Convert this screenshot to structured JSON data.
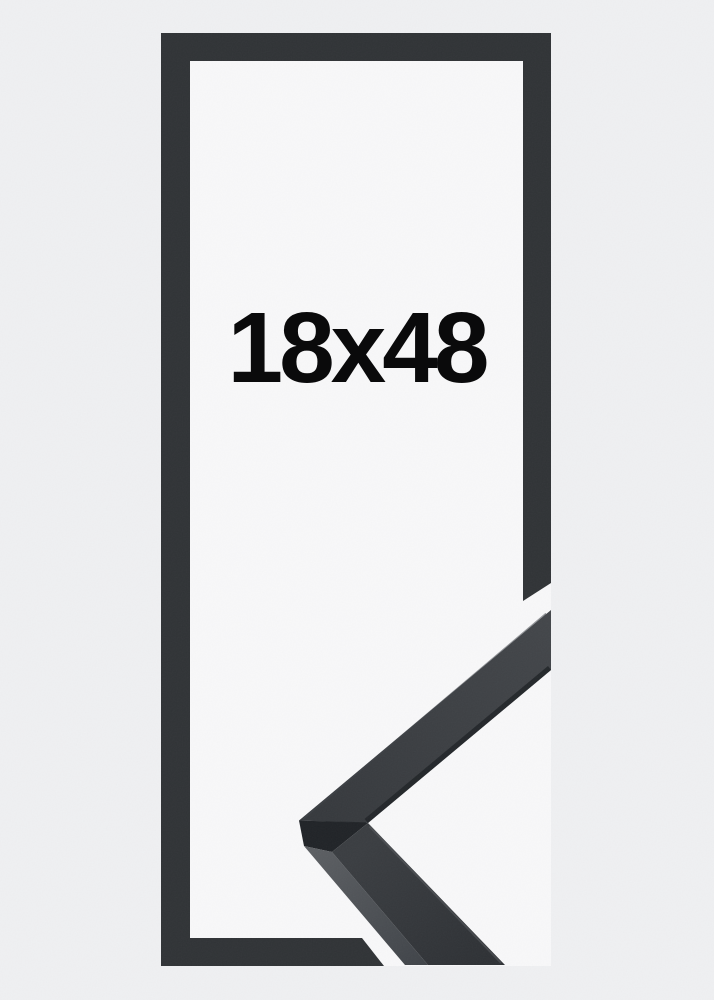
{
  "product": {
    "size_label": "18x48",
    "colors": {
      "background": "#eff0f2",
      "interior": "#f8f8f9",
      "frame": "#303336",
      "profile_top_light": "#43464a",
      "profile_top": "#36393d",
      "profile_lower_light": "#3a3d41",
      "profile_lower": "#2e3135",
      "side_light": "#5b5e62",
      "side_dark": "#404449",
      "end_face": "#202327",
      "label_text": "#0a0a0b"
    }
  }
}
